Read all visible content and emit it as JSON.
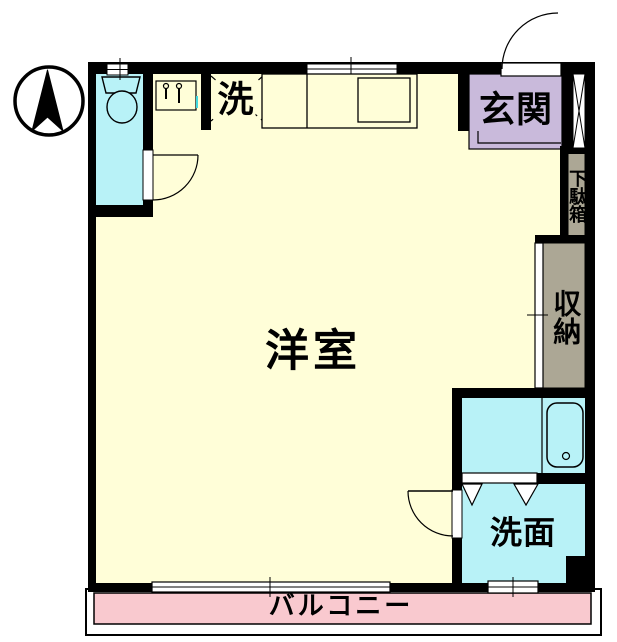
{
  "labels": {
    "western_room": "洋室",
    "entrance": "玄関",
    "shoe_cabinet": "下駄箱",
    "storage": "収納",
    "washroom": "洗面",
    "laundry": "洗",
    "balcony": "バルコニー"
  },
  "colors": {
    "floor": "#fffed8",
    "wet_area": "#b8f2f7",
    "entrance_floor": "#c9badb",
    "storage_fill": "#aca795",
    "balcony_fill": "#f9c9cf",
    "wall": "#000000",
    "fixture_accent": "#40d8e0"
  },
  "icons": {
    "compass": "north-arrow"
  }
}
